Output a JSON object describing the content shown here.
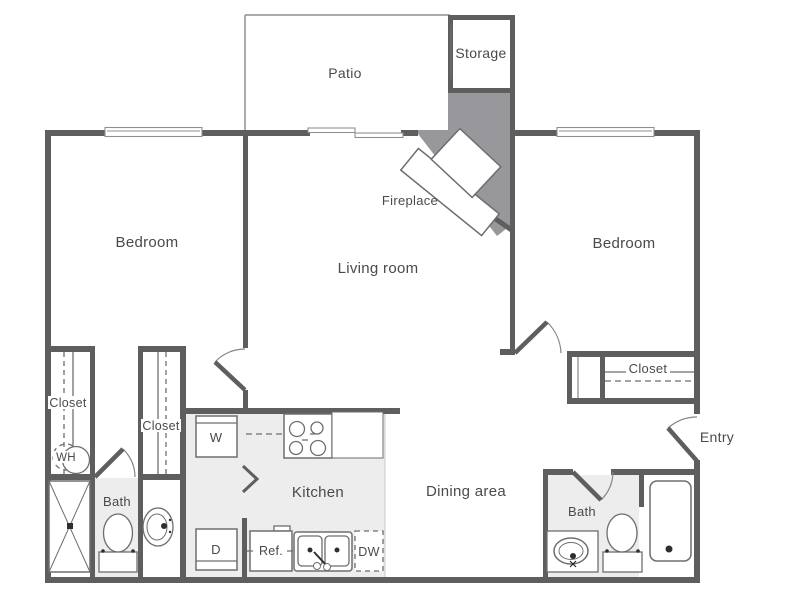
{
  "labels": {
    "patio": "Patio",
    "storage": "Storage",
    "fireplace": "Fireplace",
    "bedroom_left": "Bedroom",
    "bedroom_right": "Bedroom",
    "living_room": "Living room",
    "closet_left": "Closet",
    "closet_mid": "Closet",
    "closet_right": "Closet",
    "water_heater": "WH",
    "bath_left": "Bath",
    "bath_right": "Bath",
    "kitchen": "Kitchen",
    "dining_area": "Dining area",
    "entry": "Entry",
    "washer": "W",
    "dryer": "D",
    "fridge": "Ref.",
    "dishwasher": "DW"
  },
  "colors": {
    "wall": "#5e5e5e",
    "chimney": "#98989c",
    "floor": "#ededed",
    "fixture": "#6e6e6e",
    "window": "#8f8f8f",
    "label": "#4a4a4a"
  }
}
